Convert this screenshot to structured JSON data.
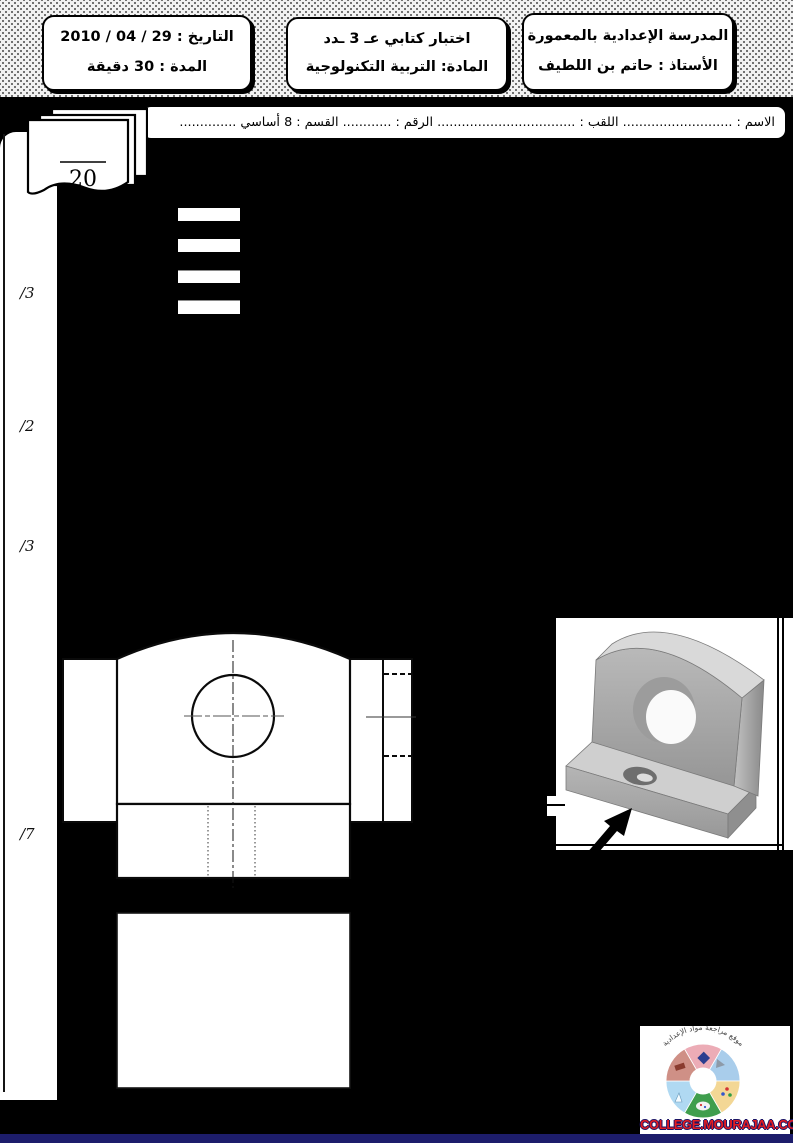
{
  "page": {
    "bg": "#000000",
    "footer_strip_color": "#1d1d6b"
  },
  "header": {
    "school_box": {
      "line1": "المدرسة الإعدادية بالمعمورة",
      "line2": "الأستاذ : حاتم بن اللطيف"
    },
    "exam_box": {
      "line1": "اختبار كتابي  عـ 3 ـدد",
      "line2": "المادة: التربية التكنولوجية"
    },
    "date_box": {
      "line1": "التاريخ : 29 / 04 / 2010",
      "line2": "المدة : 30 دقيقة"
    }
  },
  "student_line": "الاسم : ........................... اللقب : .................................. الرقم : ............ القسم : 8 أساسي ..............",
  "grade": {
    "denominator": "20"
  },
  "margin_marks": [
    {
      "label": "/3"
    },
    {
      "label": "/2"
    },
    {
      "label": "/3"
    },
    {
      "label": "/7"
    }
  ],
  "logo": {
    "site": "COLLEGE.MOURAJAA.COM",
    "arc_text": "موقع مراجعة مواد الإعدادية",
    "text_color": "#e21c21",
    "outline_color": "#1b1464",
    "emblem_colors": [
      "#ecacb6",
      "#a9cdeb",
      "#f3d795",
      "#3f9e4d",
      "#b0d9f2",
      "#cf9086"
    ]
  }
}
